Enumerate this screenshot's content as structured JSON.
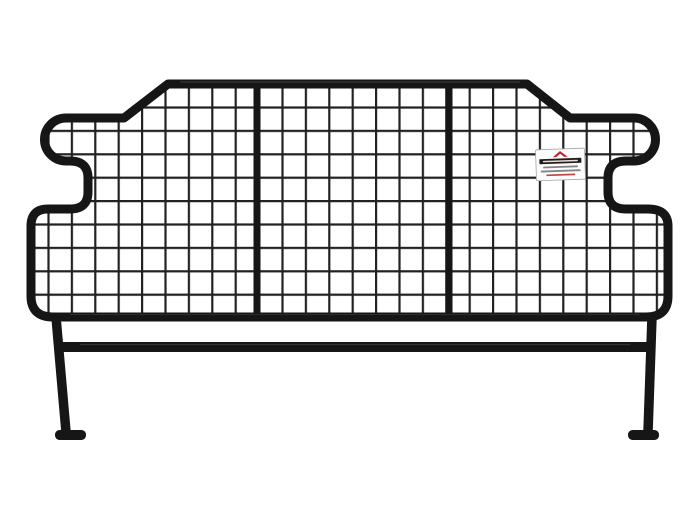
{
  "scene": {
    "description": "Product photo of a black tubular-steel dog guard pet barrier: welded wire mesh in three sections divided by two vertical tubes, stepped side contours with hook-shaped upper corners, raised centre top section, two floor legs with flat inward-pointing feet joined by a horizontal cross bar, small white brand label attached to the right side of the mesh, plain white background",
    "background_color": "#ffffff"
  },
  "barrier": {
    "frame_color": "#161616",
    "frame_highlight_color": "#4b4b4b",
    "mesh_color": "#222222",
    "mesh_cell_size_px": 23.4,
    "mesh_sections": 3,
    "divider_count": 2,
    "leg_count": 2,
    "feet_count": 2
  },
  "label": {
    "background_color": "#fcfcfc",
    "border_color": "#a6a6a6",
    "logo_color": "#c3272b",
    "band_color": "#241b19",
    "band_text_color": "#f5f5f5",
    "text_line_color": "#707070",
    "accent_line_color": "#b5342f"
  }
}
